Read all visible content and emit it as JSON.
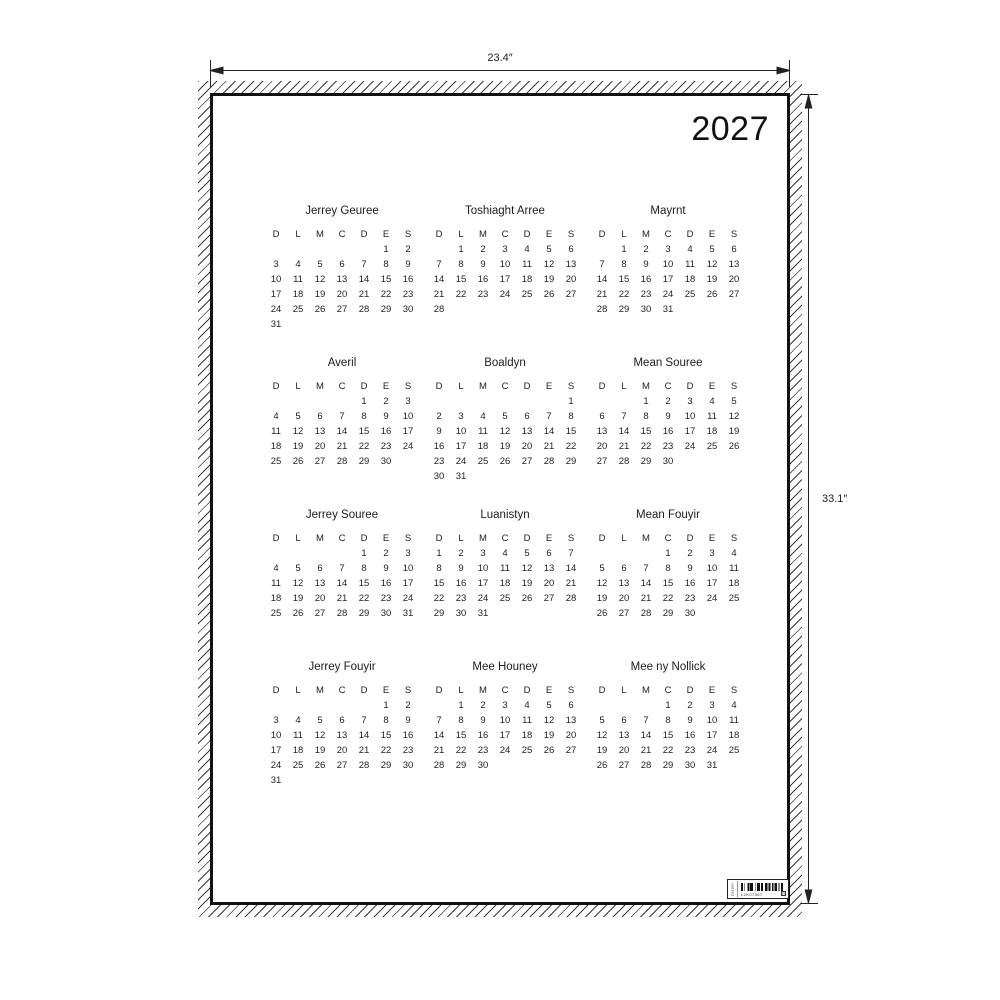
{
  "annotations": {
    "width_label": "23.4″",
    "height_label": "33.1″"
  },
  "poster": {
    "year": "2027",
    "day_headers": [
      "D",
      "L",
      "M",
      "C",
      "D",
      "E",
      "S"
    ],
    "months": [
      {
        "name": "Jerrey Geuree",
        "weeks": [
          [
            "",
            "",
            "",
            "",
            "",
            "1",
            "2"
          ],
          [
            "3",
            "4",
            "5",
            "6",
            "7",
            "8",
            "9"
          ],
          [
            "10",
            "11",
            "12",
            "13",
            "14",
            "15",
            "16"
          ],
          [
            "17",
            "18",
            "19",
            "20",
            "21",
            "22",
            "23"
          ],
          [
            "24",
            "25",
            "26",
            "27",
            "28",
            "29",
            "30"
          ],
          [
            "31",
            "",
            "",
            "",
            "",
            "",
            ""
          ]
        ]
      },
      {
        "name": "Toshiaght Arree",
        "weeks": [
          [
            "",
            "1",
            "2",
            "3",
            "4",
            "5",
            "6"
          ],
          [
            "7",
            "8",
            "9",
            "10",
            "11",
            "12",
            "13"
          ],
          [
            "14",
            "15",
            "16",
            "17",
            "18",
            "19",
            "20"
          ],
          [
            "21",
            "22",
            "23",
            "24",
            "25",
            "26",
            "27"
          ],
          [
            "28",
            "",
            "",
            "",
            "",
            "",
            ""
          ]
        ]
      },
      {
        "name": "Mayrnt",
        "weeks": [
          [
            "",
            "1",
            "2",
            "3",
            "4",
            "5",
            "6"
          ],
          [
            "7",
            "8",
            "9",
            "10",
            "11",
            "12",
            "13"
          ],
          [
            "14",
            "15",
            "16",
            "17",
            "18",
            "19",
            "20"
          ],
          [
            "21",
            "22",
            "23",
            "24",
            "25",
            "26",
            "27"
          ],
          [
            "28",
            "29",
            "30",
            "31",
            "",
            "",
            ""
          ]
        ]
      },
      {
        "name": "Averil",
        "weeks": [
          [
            "",
            "",
            "",
            "",
            "1",
            "2",
            "3"
          ],
          [
            "4",
            "5",
            "6",
            "7",
            "8",
            "9",
            "10"
          ],
          [
            "11",
            "12",
            "13",
            "14",
            "15",
            "16",
            "17"
          ],
          [
            "18",
            "19",
            "20",
            "21",
            "22",
            "23",
            "24"
          ],
          [
            "25",
            "26",
            "27",
            "28",
            "29",
            "30",
            ""
          ]
        ]
      },
      {
        "name": "Boaldyn",
        "weeks": [
          [
            "",
            "",
            "",
            "",
            "",
            "",
            "1"
          ],
          [
            "2",
            "3",
            "4",
            "5",
            "6",
            "7",
            "8"
          ],
          [
            "9",
            "10",
            "11",
            "12",
            "13",
            "14",
            "15"
          ],
          [
            "16",
            "17",
            "18",
            "19",
            "20",
            "21",
            "22"
          ],
          [
            "23",
            "24",
            "25",
            "26",
            "27",
            "28",
            "29"
          ],
          [
            "30",
            "31",
            "",
            "",
            "",
            "",
            ""
          ]
        ]
      },
      {
        "name": "Mean Souree",
        "weeks": [
          [
            "",
            "",
            "1",
            "2",
            "3",
            "4",
            "5"
          ],
          [
            "6",
            "7",
            "8",
            "9",
            "10",
            "11",
            "12"
          ],
          [
            "13",
            "14",
            "15",
            "16",
            "17",
            "18",
            "19"
          ],
          [
            "20",
            "21",
            "22",
            "23",
            "24",
            "25",
            "26"
          ],
          [
            "27",
            "28",
            "29",
            "30",
            "",
            "",
            ""
          ]
        ]
      },
      {
        "name": "Jerrey Souree",
        "weeks": [
          [
            "",
            "",
            "",
            "",
            "1",
            "2",
            "3"
          ],
          [
            "4",
            "5",
            "6",
            "7",
            "8",
            "9",
            "10"
          ],
          [
            "11",
            "12",
            "13",
            "14",
            "15",
            "16",
            "17"
          ],
          [
            "18",
            "19",
            "20",
            "21",
            "22",
            "23",
            "24"
          ],
          [
            "25",
            "26",
            "27",
            "28",
            "29",
            "30",
            "31"
          ]
        ]
      },
      {
        "name": "Luanistyn",
        "weeks": [
          [
            "1",
            "2",
            "3",
            "4",
            "5",
            "6",
            "7"
          ],
          [
            "8",
            "9",
            "10",
            "11",
            "12",
            "13",
            "14"
          ],
          [
            "15",
            "16",
            "17",
            "18",
            "19",
            "20",
            "21"
          ],
          [
            "22",
            "23",
            "24",
            "25",
            "26",
            "27",
            "28"
          ],
          [
            "29",
            "30",
            "31",
            "",
            "",
            "",
            ""
          ]
        ]
      },
      {
        "name": "Mean Fouyir",
        "weeks": [
          [
            "",
            "",
            "",
            "1",
            "2",
            "3",
            "4"
          ],
          [
            "5",
            "6",
            "7",
            "8",
            "9",
            "10",
            "11"
          ],
          [
            "12",
            "13",
            "14",
            "15",
            "16",
            "17",
            "18"
          ],
          [
            "19",
            "20",
            "21",
            "22",
            "23",
            "24",
            "25"
          ],
          [
            "26",
            "27",
            "28",
            "29",
            "30",
            "",
            ""
          ]
        ]
      },
      {
        "name": "Jerrey Fouyir",
        "weeks": [
          [
            "",
            "",
            "",
            "",
            "",
            "1",
            "2"
          ],
          [
            "3",
            "4",
            "5",
            "6",
            "7",
            "8",
            "9"
          ],
          [
            "10",
            "11",
            "12",
            "13",
            "14",
            "15",
            "16"
          ],
          [
            "17",
            "18",
            "19",
            "20",
            "21",
            "22",
            "23"
          ],
          [
            "24",
            "25",
            "26",
            "27",
            "28",
            "29",
            "30"
          ],
          [
            "31",
            "",
            "",
            "",
            "",
            "",
            ""
          ]
        ]
      },
      {
        "name": "Mee Houney",
        "weeks": [
          [
            "",
            "1",
            "2",
            "3",
            "4",
            "5",
            "6"
          ],
          [
            "7",
            "8",
            "9",
            "10",
            "11",
            "12",
            "13"
          ],
          [
            "14",
            "15",
            "16",
            "17",
            "18",
            "19",
            "20"
          ],
          [
            "21",
            "22",
            "23",
            "24",
            "25",
            "26",
            "27"
          ],
          [
            "28",
            "29",
            "30",
            "",
            "",
            "",
            ""
          ]
        ]
      },
      {
        "name": "Mee ny Nollick",
        "weeks": [
          [
            "",
            "",
            "",
            "1",
            "2",
            "3",
            "4"
          ],
          [
            "5",
            "6",
            "7",
            "8",
            "9",
            "10",
            "11"
          ],
          [
            "12",
            "13",
            "14",
            "15",
            "16",
            "17",
            "18"
          ],
          [
            "19",
            "20",
            "21",
            "22",
            "23",
            "24",
            "25"
          ],
          [
            "26",
            "27",
            "28",
            "29",
            "30",
            "31",
            ""
          ]
        ]
      }
    ]
  },
  "barcode": {
    "side_text": "zazzle",
    "code_text": "L2K07367",
    "corner_mark": "R"
  },
  "colors": {
    "ink": "#1a1a1a",
    "background": "#ffffff"
  }
}
